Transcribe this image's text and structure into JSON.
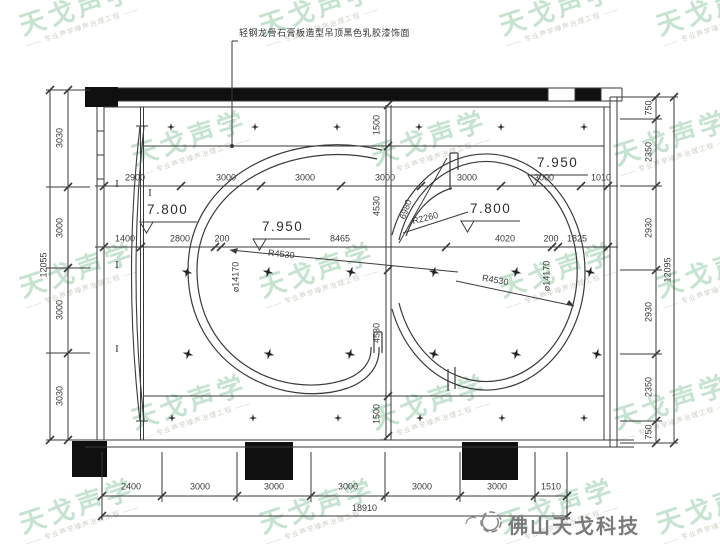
{
  "annotation": "轻钢龙骨石膏板造型吊顶黑色乳胶漆饰面",
  "elevations": [
    "7.800",
    "7.950",
    "7.800",
    "7.950"
  ],
  "radius_labels": {
    "left_radius": "R4530",
    "right_radius": "R4530",
    "small_radius": "R2260",
    "radial_dim": "6980",
    "left_diameter": "⌀14170",
    "right_diameter": "⌀14170"
  },
  "dimensions": {
    "top_row": [
      "2900",
      "3000",
      "3000",
      "3000",
      "3000",
      "3000",
      "1010"
    ],
    "mid_row": [
      "1400",
      "2800",
      "200",
      "8465",
      "4020",
      "200",
      "1825"
    ],
    "bottom_row": [
      "2400",
      "3000",
      "3000",
      "3000",
      "3000",
      "3000",
      "1510"
    ],
    "bottom_total": "18910",
    "left_column": [
      "3030",
      "3000",
      "3000",
      "3030"
    ],
    "left_total": "12055",
    "right_column": [
      "750",
      "2350",
      "2930",
      "2930",
      "2350",
      "750"
    ],
    "right_total": "12095",
    "center_column": [
      "1500",
      "4530",
      "4530",
      "1500"
    ]
  },
  "grid_markers": [
    "I",
    "I",
    "I",
    "I"
  ],
  "watermark": {
    "text": "天戈声学",
    "subtext": "—— 专业声学噪声治理工程 ——"
  },
  "logo": {
    "text": "佛山天戈科技"
  },
  "colors": {
    "line": "#3a3a3a",
    "black_fill": "#101010",
    "watermark_green": "#8cc8a2",
    "logo_gray": "#7a7a7a"
  }
}
